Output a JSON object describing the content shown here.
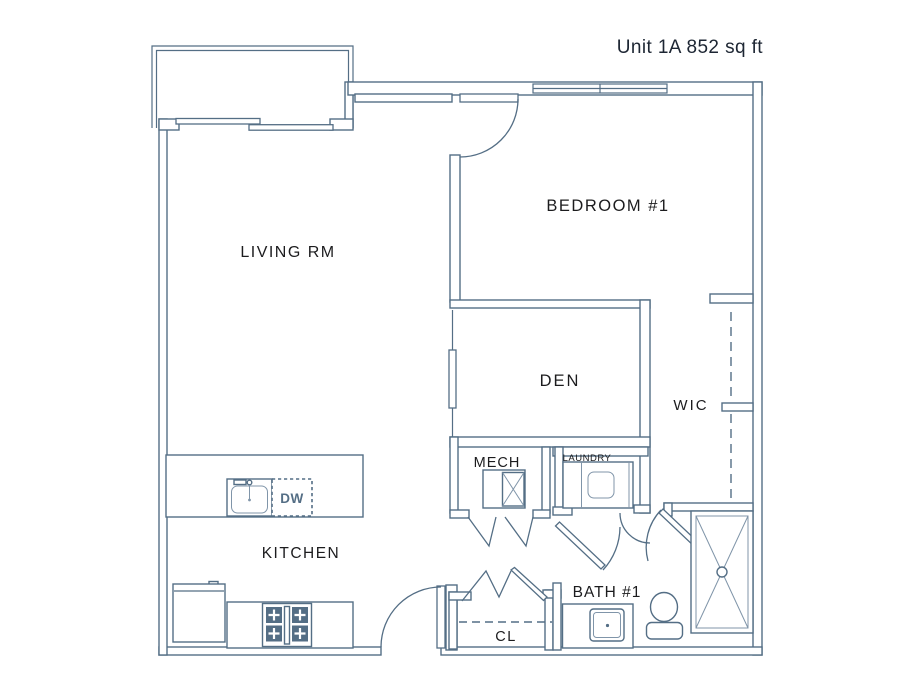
{
  "title": "Unit 1A 852 sq ft",
  "colors": {
    "wall": "#546e85",
    "wall_light": "#8095a9",
    "label": "#1c1c1e",
    "title": "#1d2633"
  },
  "labels": {
    "living": "LIVING RM",
    "bedroom": "BEDROOM #1",
    "den": "DEN",
    "wic": "WIC",
    "mech": "MECH",
    "laundry": "LAUNDRY",
    "kitchen": "KITCHEN",
    "bath": "BATH #1",
    "closet": "CL",
    "dishwasher": "DW"
  }
}
